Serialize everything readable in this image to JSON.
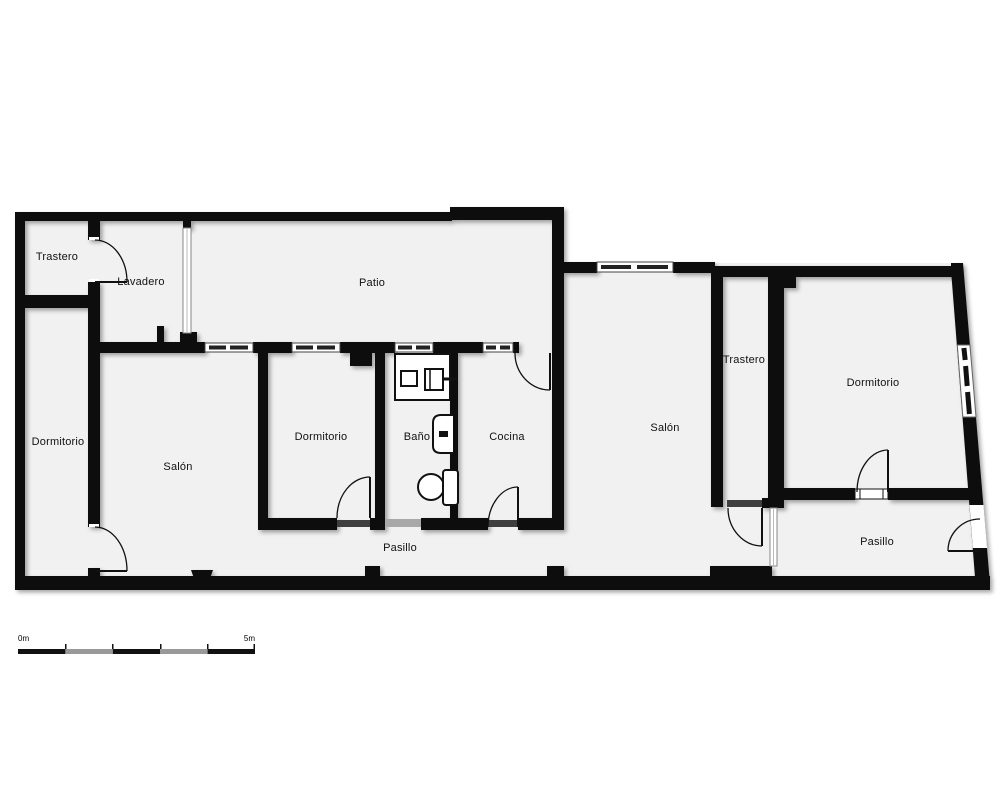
{
  "rooms": {
    "trastero_top_left": "Trastero",
    "lavadero": "Lavadero",
    "patio": "Patio",
    "dormitorio_left": "Dormitorio",
    "salon_left": "Salón",
    "dormitorio_middle": "Dormitorio",
    "bano": "Baño",
    "cocina": "Cocina",
    "pasillo_left": "Pasillo",
    "salon_right": "Salón",
    "trastero_right": "Trastero",
    "dormitorio_right": "Dormitorio",
    "pasillo_right": "Pasillo"
  },
  "scale_bar": {
    "start_label": "0m",
    "end_label": "5m"
  },
  "colors": {
    "wall": "#0d0d0d",
    "room_fill": "#f1f1f1",
    "background": "#ffffff",
    "window_glass": "#ffffff",
    "door_threshold": "#3f3f3f",
    "sliding_door": "#a8a8a8",
    "scale_alt_segment": "#999999"
  }
}
